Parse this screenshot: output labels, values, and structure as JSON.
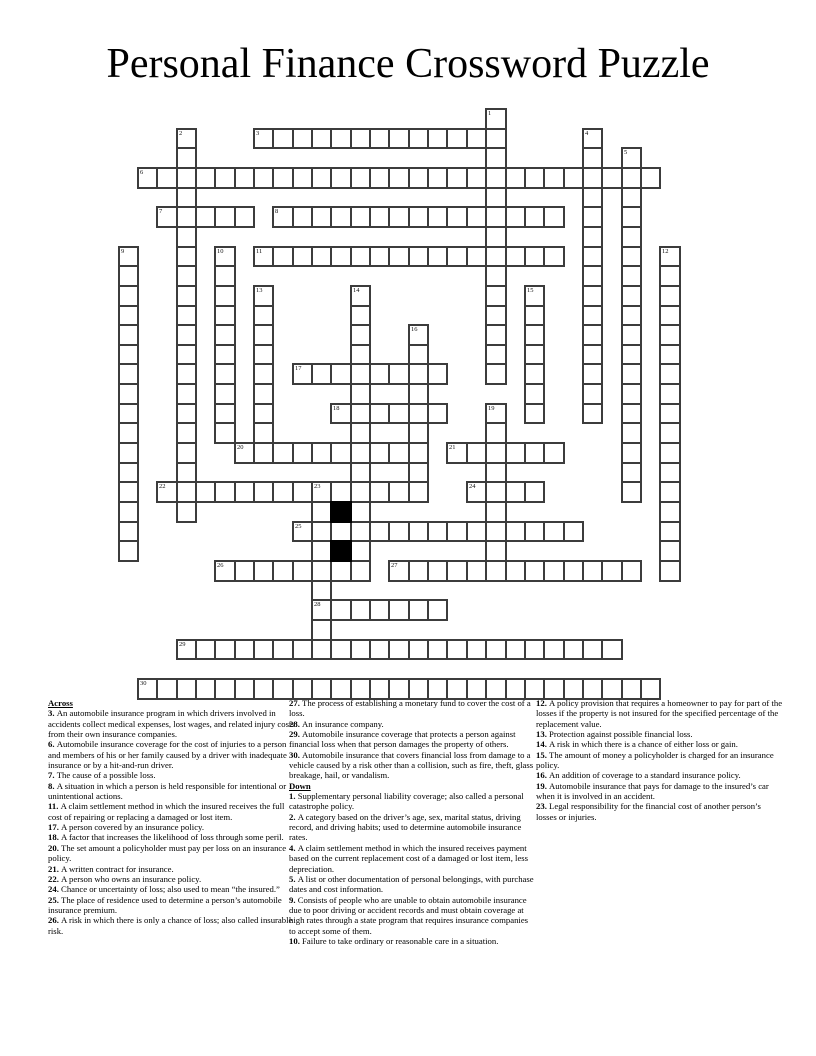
{
  "title": "Personal Finance Crossword Puzzle",
  "grid": {
    "origin_x": 117.5,
    "origin_y": 108,
    "cell_w": 19.35,
    "cell_h": 19.65,
    "cols": 29,
    "rows": 30,
    "border_color": "#3c3c3c",
    "black_color": "#000000",
    "black_cells": [
      [
        20,
        11
      ],
      [
        22,
        11
      ]
    ],
    "words": [
      {
        "num": 1,
        "dir": "D",
        "row": 0,
        "col": 19,
        "len": 14
      },
      {
        "num": 2,
        "dir": "D",
        "row": 1,
        "col": 3,
        "len": 20
      },
      {
        "num": 3,
        "dir": "A",
        "row": 1,
        "col": 7,
        "len": 13
      },
      {
        "num": 4,
        "dir": "D",
        "row": 1,
        "col": 24,
        "len": 15
      },
      {
        "num": 5,
        "dir": "D",
        "row": 2,
        "col": 26,
        "len": 18
      },
      {
        "num": 6,
        "dir": "A",
        "row": 3,
        "col": 1,
        "len": 27
      },
      {
        "num": 7,
        "dir": "A",
        "row": 5,
        "col": 2,
        "len": 5
      },
      {
        "num": 8,
        "dir": "A",
        "row": 5,
        "col": 8,
        "len": 15
      },
      {
        "num": 9,
        "dir": "D",
        "row": 7,
        "col": 0,
        "len": 16
      },
      {
        "num": 10,
        "dir": "D",
        "row": 7,
        "col": 5,
        "len": 10
      },
      {
        "num": 11,
        "dir": "A",
        "row": 7,
        "col": 7,
        "len": 16
      },
      {
        "num": 12,
        "dir": "D",
        "row": 7,
        "col": 28,
        "len": 17
      },
      {
        "num": 13,
        "dir": "D",
        "row": 9,
        "col": 7,
        "len": 9
      },
      {
        "num": 14,
        "dir": "D",
        "row": 9,
        "col": 12,
        "len": 15
      },
      {
        "num": 15,
        "dir": "D",
        "row": 9,
        "col": 21,
        "len": 7
      },
      {
        "num": 16,
        "dir": "D",
        "row": 11,
        "col": 15,
        "len": 9
      },
      {
        "num": 17,
        "dir": "A",
        "row": 13,
        "col": 9,
        "len": 8
      },
      {
        "num": 18,
        "dir": "A",
        "row": 15,
        "col": 11,
        "len": 6
      },
      {
        "num": 19,
        "dir": "D",
        "row": 15,
        "col": 19,
        "len": 9
      },
      {
        "num": 20,
        "dir": "A",
        "row": 17,
        "col": 6,
        "len": 10
      },
      {
        "num": 21,
        "dir": "A",
        "row": 17,
        "col": 17,
        "len": 6
      },
      {
        "num": 22,
        "dir": "A",
        "row": 19,
        "col": 2,
        "len": 13
      },
      {
        "num": 23,
        "dir": "D",
        "row": 19,
        "col": 10,
        "len": 9
      },
      {
        "num": 24,
        "dir": "A",
        "row": 19,
        "col": 18,
        "len": 4
      },
      {
        "num": 25,
        "dir": "A",
        "row": 21,
        "col": 9,
        "len": 15
      },
      {
        "num": 26,
        "dir": "A",
        "row": 23,
        "col": 5,
        "len": 8
      },
      {
        "num": 27,
        "dir": "A",
        "row": 23,
        "col": 14,
        "len": 13
      },
      {
        "num": 28,
        "dir": "A",
        "row": 25,
        "col": 10,
        "len": 7
      },
      {
        "num": 29,
        "dir": "A",
        "row": 27,
        "col": 3,
        "len": 23
      },
      {
        "num": 30,
        "dir": "A",
        "row": 29,
        "col": 1,
        "len": 27
      }
    ]
  },
  "clues": {
    "columns": [
      {
        "left": 48,
        "top": 698,
        "items": [
          {
            "h": "Across"
          },
          {
            "n": "3",
            "t": "An automobile insurance program in which drivers involved in accidents collect medical expenses, lost wages, and related injury costs from their own insurance companies."
          },
          {
            "n": "6",
            "t": "Automobile insurance coverage for the cost of injuries to a person and members of his or her family caused by a driver with inadequate insurance or by a hit-and-run driver."
          },
          {
            "n": "7",
            "t": "The cause of a possible loss."
          },
          {
            "n": "8",
            "t": "A situation in which a person is held responsible for intentional or unintentional actions."
          },
          {
            "n": "11",
            "t": "A claim settlement method in which the insured receives the full cost of repairing or replacing a damaged or lost item."
          },
          {
            "n": "17",
            "t": "A person covered by an insurance policy."
          },
          {
            "n": "18",
            "t": "A factor that increases the likelihood of loss through some peril."
          },
          {
            "n": "20",
            "t": "The set amount a policyholder must pay per loss on an insurance policy."
          },
          {
            "n": "21",
            "t": "A written contract for insurance."
          },
          {
            "n": "22",
            "t": "A person who owns an insurance policy."
          },
          {
            "n": "24",
            "t": "Chance or uncertainty of loss; also used to mean “the insured.”"
          },
          {
            "n": "25",
            "t": "The place of residence used to determine a person’s automobile insurance premium."
          },
          {
            "n": "26",
            "t": "A risk in which there is only a chance of loss; also called insurable risk."
          }
        ]
      },
      {
        "left": 289,
        "top": 698,
        "items": [
          {
            "n": "27",
            "t": "The process of establishing a monetary fund to cover the cost of a loss."
          },
          {
            "n": "28",
            "t": "An insurance company."
          },
          {
            "n": "29",
            "t": "Automobile insurance coverage that protects a person against financial loss when that person damages the property of others."
          },
          {
            "n": "30",
            "t": "Automobile insurance that covers financial loss from damage to a vehicle caused by a risk other than a collision, such as fire, theft, glass breakage, hail, or vandalism."
          },
          {
            "h": "Down"
          },
          {
            "n": "1",
            "t": "Supplementary personal liability coverage; also called a personal catastrophe policy."
          },
          {
            "n": "2",
            "t": "A category based on the driver’s age, sex, marital status, driving record, and driving habits; used to determine automobile insurance rates."
          },
          {
            "n": "4",
            "t": "A claim settlement method in which the insured receives payment based on the current replacement cost of a damaged or lost item, less depreciation."
          },
          {
            "n": "5",
            "t": "A list or other documentation of personal belongings, with purchase dates and cost information."
          },
          {
            "n": "9",
            "t": "Consists of people who are unable to obtain automobile insurance due to poor driving or accident records and must obtain coverage at high rates through a state program that requires insurance companies to accept some of them."
          },
          {
            "n": "10",
            "t": "Failure to take ordinary or reasonable care in a situation."
          }
        ]
      },
      {
        "left": 536,
        "top": 698,
        "items": [
          {
            "n": "12",
            "t": "A policy provision that requires a homeowner to pay for part of the losses if the property is not insured for the specified percentage of the replacement value."
          },
          {
            "n": "13",
            "t": "Protection against possible financial loss."
          },
          {
            "n": "14",
            "t": "A risk in which there is a chance of either loss or gain."
          },
          {
            "n": "15",
            "t": "The amount of money a policyholder is charged for an insurance policy."
          },
          {
            "n": "16",
            "t": "An addition of coverage to a standard insurance policy."
          },
          {
            "n": "19",
            "t": "Automobile insurance that pays for damage to the insured’s car when it is involved in an accident."
          },
          {
            "n": "23",
            "t": "Legal responsibility for the financial cost of another person’s losses or injuries."
          }
        ]
      }
    ]
  }
}
